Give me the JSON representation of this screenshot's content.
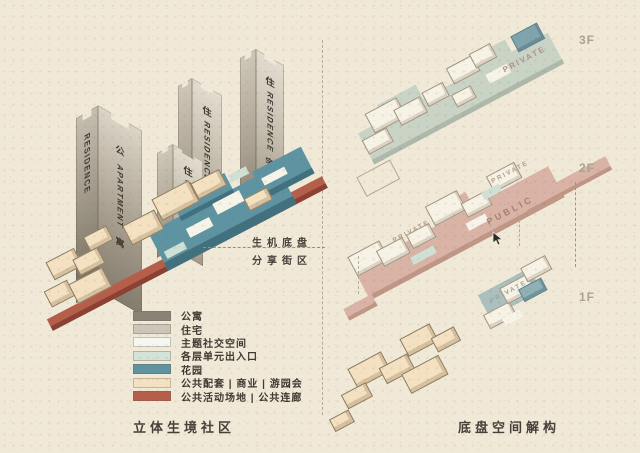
{
  "left_diagram": {
    "caption": "立体生境社区",
    "annotation": {
      "line1": "生机底盘",
      "line2": "分享街区"
    },
    "towers": [
      {
        "id": "apartment-tower",
        "left_face": "RESIDENCE",
        "cjk_top": "公",
        "latin": "APARTMENT",
        "cjk_bottom": "寓"
      },
      {
        "id": "residence-tower-front",
        "cjk_top": "住",
        "latin": "RESIDENCE",
        "cjk_bottom": "宅"
      },
      {
        "id": "residence-tower-mid",
        "cjk_top": "住",
        "latin": "RESIDENCE",
        "cjk_bottom": "宅"
      },
      {
        "id": "residence-tower-right",
        "cjk_top": "住",
        "latin": "RESIDENCE",
        "cjk_bottom": "宅"
      }
    ],
    "legend": [
      {
        "label": "公寓",
        "color": "#8a8478"
      },
      {
        "label": "住宅",
        "color": "#cbc6ba"
      },
      {
        "label": "主题社交空间",
        "color": "#f4f6f0"
      },
      {
        "label": "各层单元出入口",
        "color": "#d4e2d8"
      },
      {
        "label": "花园",
        "color": "#5e93a2"
      },
      {
        "label": "公共配套 | 商业 | 游园会",
        "color": "#f3e1c1"
      },
      {
        "label": "公共活动场地 | 公共连廊",
        "color": "#b55f4b"
      }
    ]
  },
  "right_diagram": {
    "caption": "底盘空间解构",
    "levels": [
      {
        "label": "3F",
        "tag": "PRIVATE"
      },
      {
        "label": "2F",
        "tag": "PUBLIC",
        "sub_tag_a": "PRIVATE",
        "sub_tag_b": "PRIVATE"
      },
      {
        "label": "1F",
        "tag": "PRIVATE"
      }
    ]
  },
  "colors": {
    "background": "#f1e9d8",
    "garden_teal": "#5e93a2",
    "walkway_red": "#b55f4b",
    "podium_cream": "#f3e1c1",
    "slab_3f": "#c9d3c6",
    "slab_2f": "#d9b3a6"
  }
}
